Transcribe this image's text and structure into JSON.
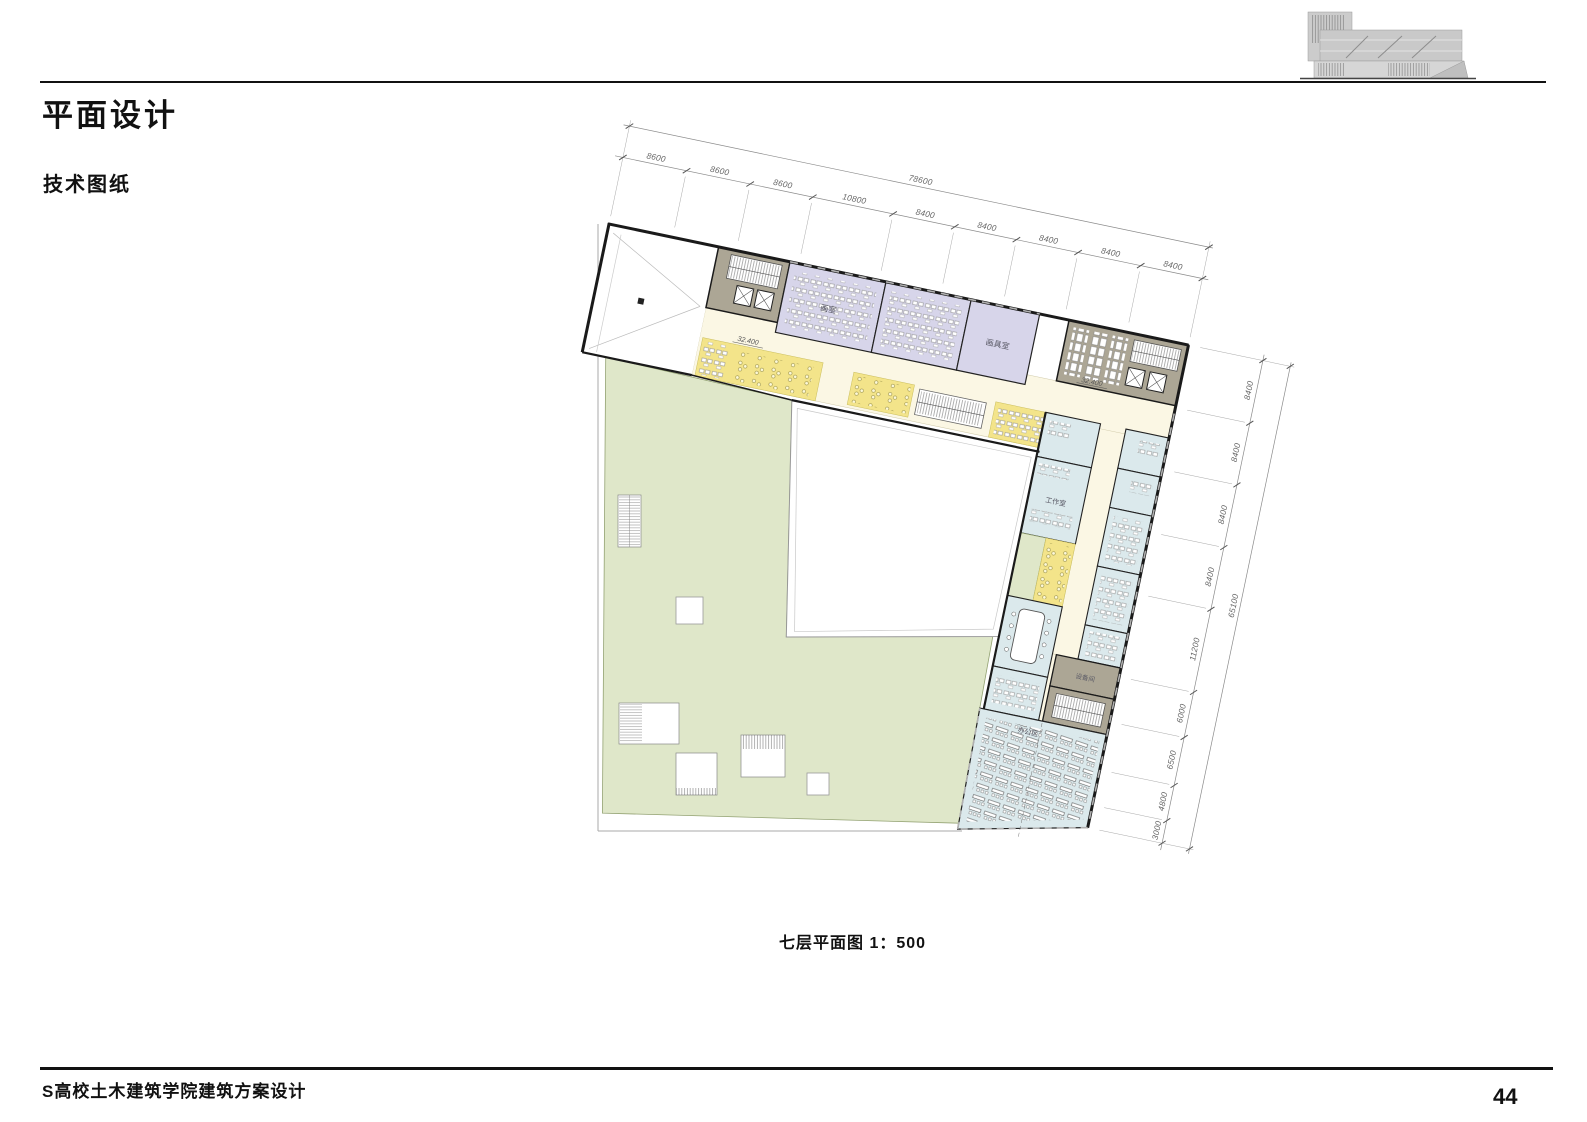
{
  "page": {
    "title": "平面设计",
    "subtitle": "技术图纸",
    "caption": "七层平面图  1：500",
    "footer": "S高校土木建筑学院建筑方案设计",
    "page_number": "44"
  },
  "plan": {
    "rooms": {
      "studio": "画室",
      "art_supply": "画具室",
      "workshop": "工作室",
      "equipment": "设备间",
      "office_area": "办公区"
    },
    "levels": {
      "left": "32.400",
      "right": "32.400"
    },
    "dimensions": {
      "top": {
        "segments": [
          "8600",
          "8600",
          "8600",
          "10800",
          "8400",
          "8400",
          "8400",
          "8400",
          "8400"
        ],
        "total": "78600"
      },
      "right": {
        "segments": [
          "8400",
          "8400",
          "8400",
          "8400",
          "11200",
          "6000",
          "6500",
          "4800",
          "3000"
        ],
        "total": "65100"
      }
    },
    "colors": {
      "roof_green": "#dfe7c9",
      "studio_purple": "#d7d5ea",
      "office_blue": "#dbe9ec",
      "corridor_cream": "#fbf7e4",
      "seating_yellow": "#f3e48a",
      "core_brown": "#aca695",
      "wall": "#1a1a1a"
    }
  }
}
